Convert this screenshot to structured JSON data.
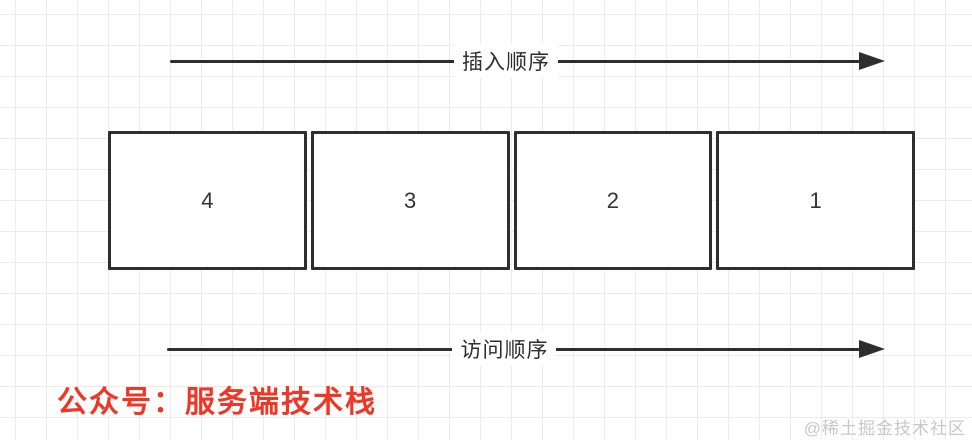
{
  "colors": {
    "stroke": "#2d2d32",
    "grid": "#ececec",
    "red": "#ee3726",
    "watermark": "#c8c8c8"
  },
  "arrows": {
    "top": {
      "label": "插入顺序",
      "direction": "right"
    },
    "bottom": {
      "label": "访问顺序",
      "direction": "right"
    }
  },
  "boxes": [
    "4",
    "3",
    "2",
    "1"
  ],
  "footer": {
    "caption": "公众号：服务端技术栈"
  },
  "watermark": {
    "text": "@稀土掘金技术社区"
  }
}
